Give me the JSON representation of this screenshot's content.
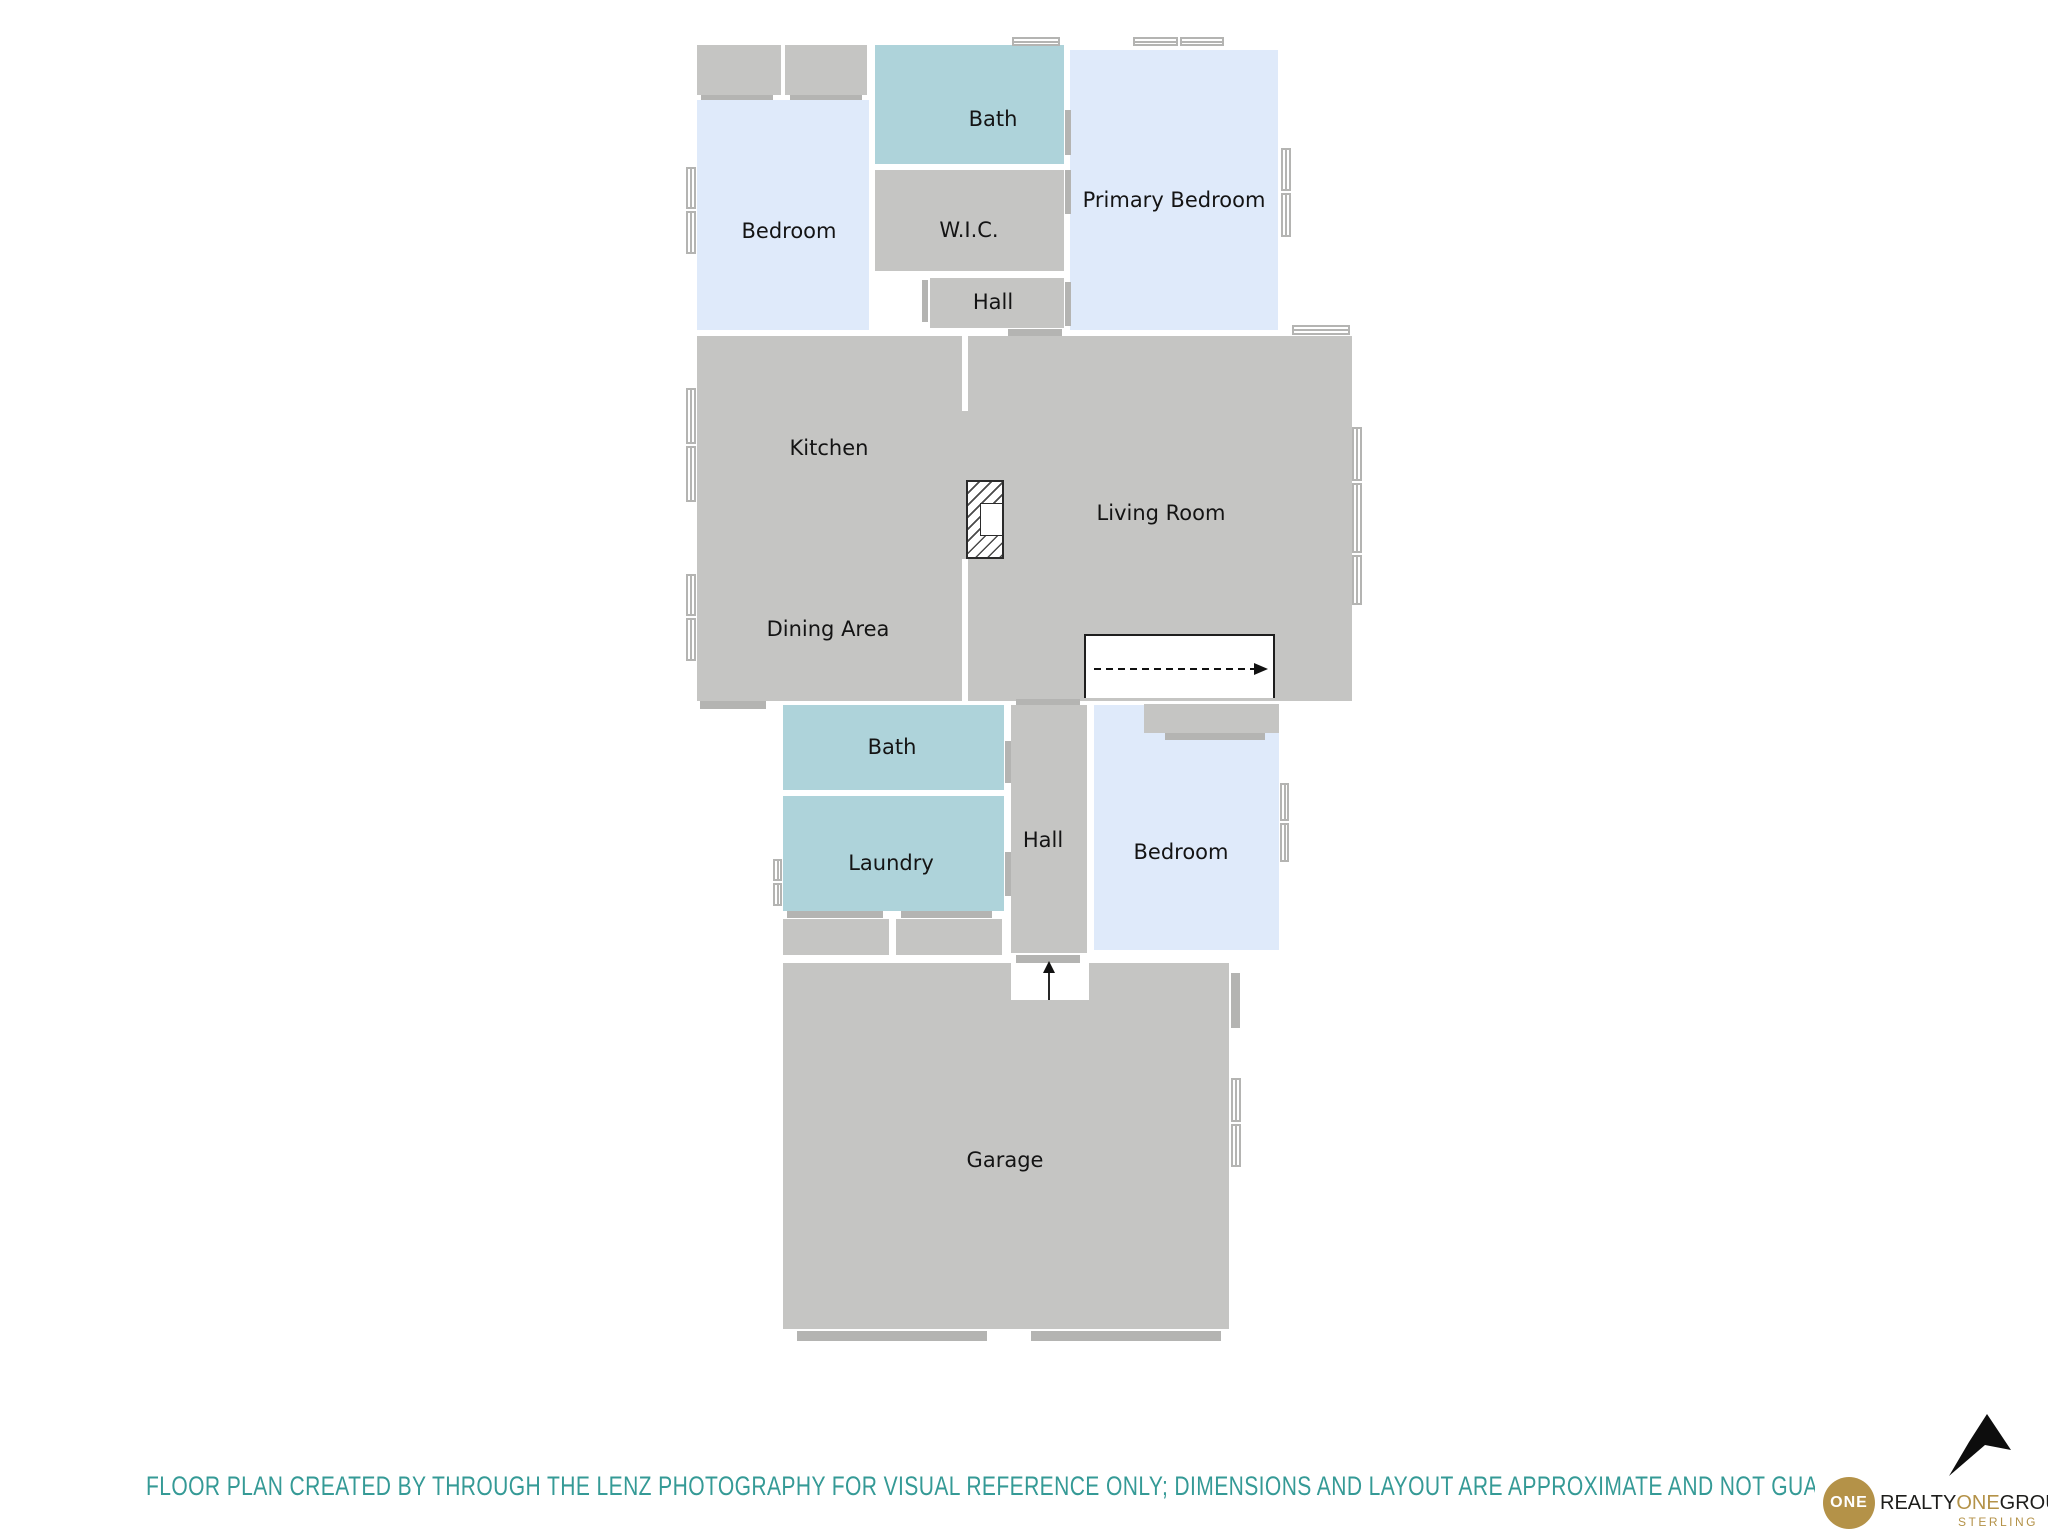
{
  "rooms": {
    "bedroom_upper": {
      "label": "Bedroom"
    },
    "bath_upper": {
      "label": "Bath"
    },
    "wic": {
      "label": "W.I.C."
    },
    "hall_upper": {
      "label": "Hall"
    },
    "primary_bedroom": {
      "label": "Primary Bedroom"
    },
    "kitchen": {
      "label": "Kitchen"
    },
    "living_room": {
      "label": "Living Room"
    },
    "dining_area": {
      "label": "Dining Area"
    },
    "bath_lower": {
      "label": "Bath"
    },
    "laundry": {
      "label": "Laundry"
    },
    "hall_lower": {
      "label": "Hall"
    },
    "bedroom_lower": {
      "label": "Bedroom"
    },
    "garage": {
      "label": "Garage"
    }
  },
  "colors": {
    "room_gray": "#c5c5c3",
    "room_teal": "#aed3da",
    "room_blue": "#dfeafa",
    "marker_gray": "#b4b4b2",
    "disclaimer_teal": "#359a96",
    "logo_gold": "#b49248",
    "logo_black": "#1d1d1b"
  },
  "footer": {
    "disclaimer": "FLOOR PLAN CREATED BY THROUGH THE LENZ PHOTOGRAPHY FOR VISUAL REFERENCE ONLY; DIMENSIONS AND LAYOUT ARE APPROXIMATE AND NOT GUARANTEED FOR ACCURACY"
  },
  "logo": {
    "circle_text": "ONE",
    "brand_realty": "REALTY",
    "brand_one": "ONE",
    "brand_group": "GROUP",
    "brand_sub": "STERLING"
  }
}
